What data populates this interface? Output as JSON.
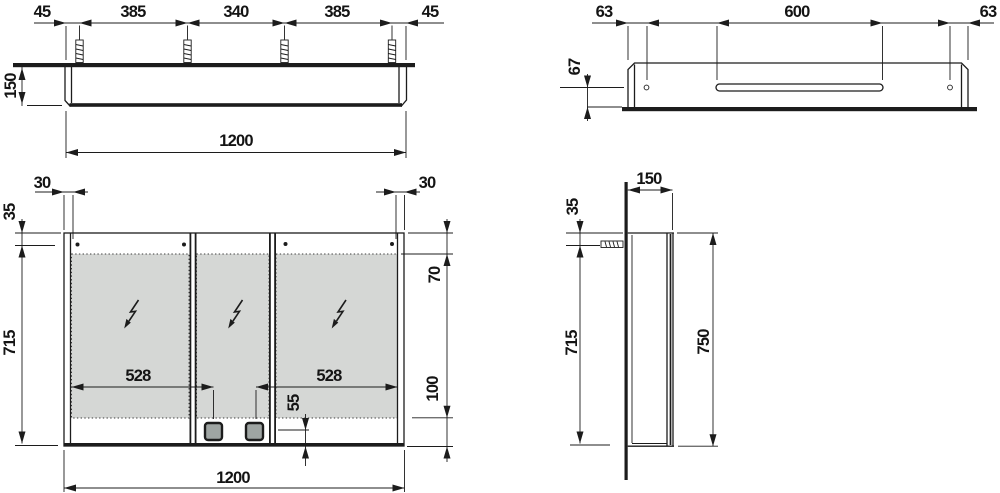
{
  "drawing": {
    "colors": {
      "line": "#1c1c1c",
      "mirror_fill": "#d5d7d5",
      "socket_fill": "#9fa5a3"
    },
    "top_view": {
      "d45l": "45",
      "d385l": "385",
      "d340": "340",
      "d385r": "385",
      "d45r": "45",
      "d150": "150",
      "d1200": "1200"
    },
    "underside_view": {
      "d63l": "63",
      "d600": "600",
      "d63r": "63",
      "d67": "67"
    },
    "front_view": {
      "d30l": "30",
      "d30r": "30",
      "d35": "35",
      "d715": "715",
      "d70": "70",
      "d528l": "528",
      "d528r": "528",
      "d55": "55",
      "d100": "100",
      "d1200": "1200"
    },
    "side_view": {
      "d150": "150",
      "d35": "35",
      "d715": "715",
      "d750": "750"
    }
  }
}
